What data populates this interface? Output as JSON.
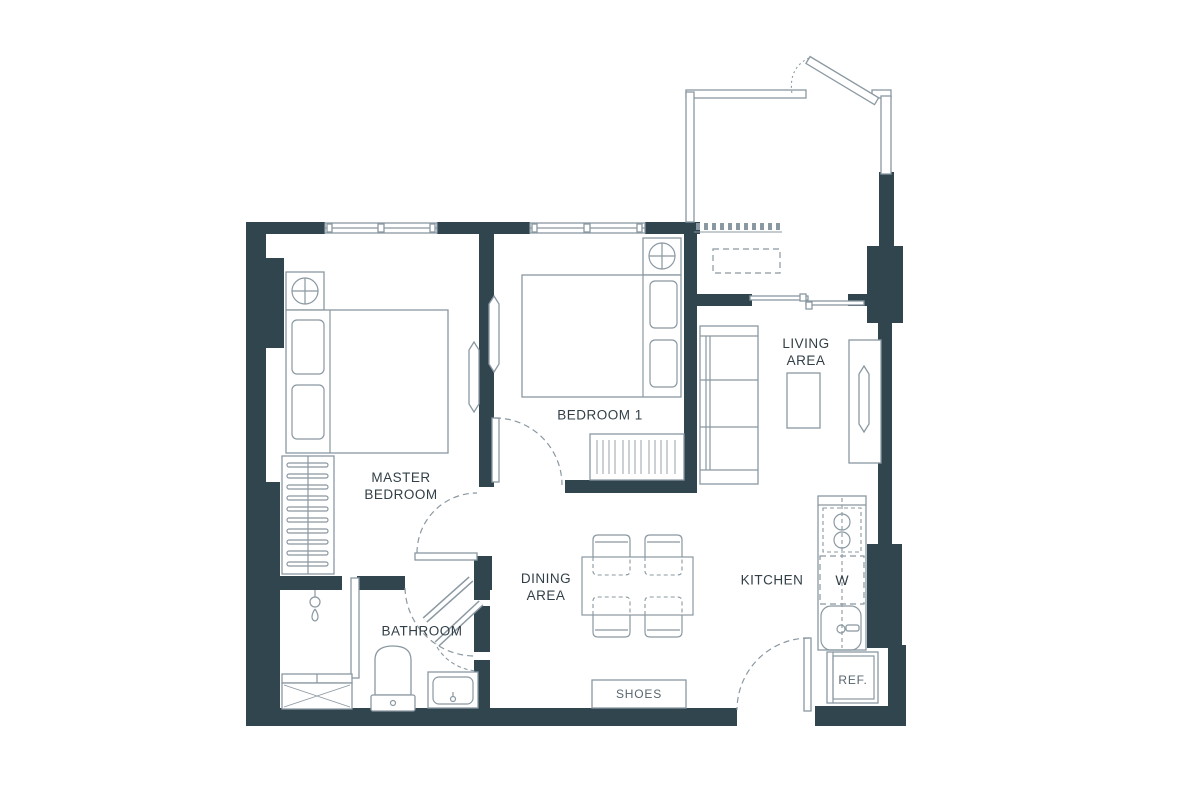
{
  "colors": {
    "wall": "#31454F",
    "line": "#8A98A1",
    "text": "#323F47"
  },
  "labels": {
    "master_bedroom_line1": "MASTER",
    "master_bedroom_line2": "BEDROOM",
    "bedroom1": "BEDROOM 1",
    "living_line1": "LIVING",
    "living_line2": "AREA",
    "dining_line1": "DINING",
    "dining_line2": "AREA",
    "kitchen": "KITCHEN",
    "bathroom": "BATHROOM",
    "washer": "W",
    "refrigerator": "REF.",
    "shoes": "SHOES"
  }
}
